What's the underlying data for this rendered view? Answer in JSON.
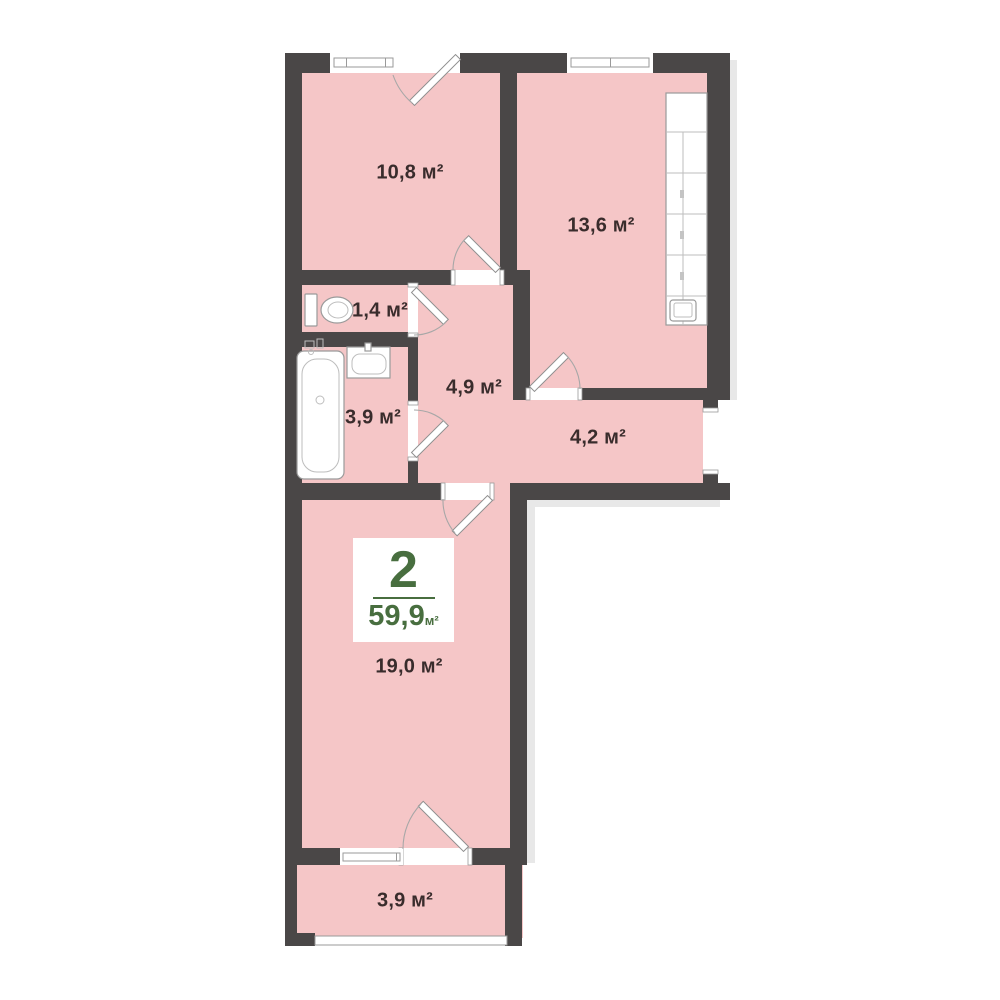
{
  "plan": {
    "colors": {
      "wall": "#4a4747",
      "room_fill": "#f5c6c7",
      "accent_green": "#486e3f",
      "label_text": "#392c2c",
      "line_gray": "#9a9a9a"
    },
    "badge": {
      "room_count": "2",
      "total_area": "59,9",
      "unit": "м²"
    },
    "rooms": [
      {
        "area_label": "10,8 м²"
      },
      {
        "area_label": "13,6 м²"
      },
      {
        "area_label": "1,4 м²"
      },
      {
        "area_label": "4,9 м²"
      },
      {
        "area_label": "3,9 м²"
      },
      {
        "area_label": "4,2 м²"
      },
      {
        "area_label": "19,0 м²"
      },
      {
        "area_label": "3,9 м²"
      }
    ]
  }
}
